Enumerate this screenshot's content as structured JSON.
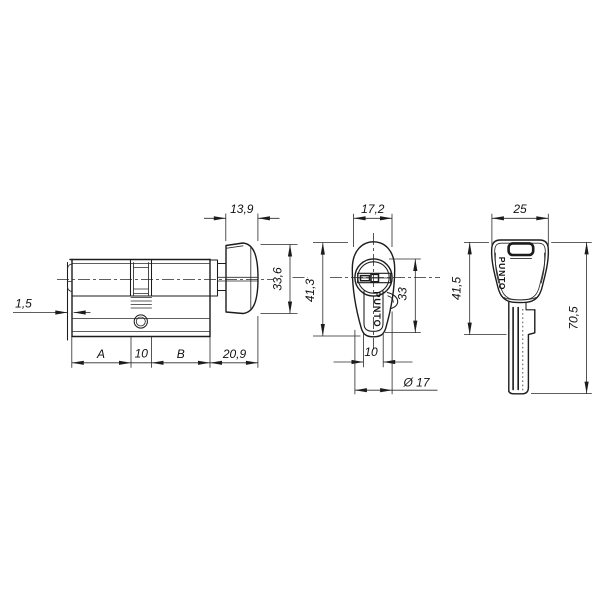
{
  "brand": "PUNTO",
  "side_view": {
    "face_protrusion": "1,5",
    "dim_a": "A",
    "dim_center": "10",
    "dim_b": "B",
    "knob_length": "20,9",
    "knob_depth": "13,9",
    "knob_diameter": "33,6"
  },
  "front_view": {
    "top_width": "17,2",
    "overall_height": "41,3",
    "profile_height": "33",
    "spine_width": "10",
    "face_diameter": "Ø 17"
  },
  "key_view": {
    "head_width": "25",
    "head_length": "41,5",
    "overall_length": "70,5"
  }
}
